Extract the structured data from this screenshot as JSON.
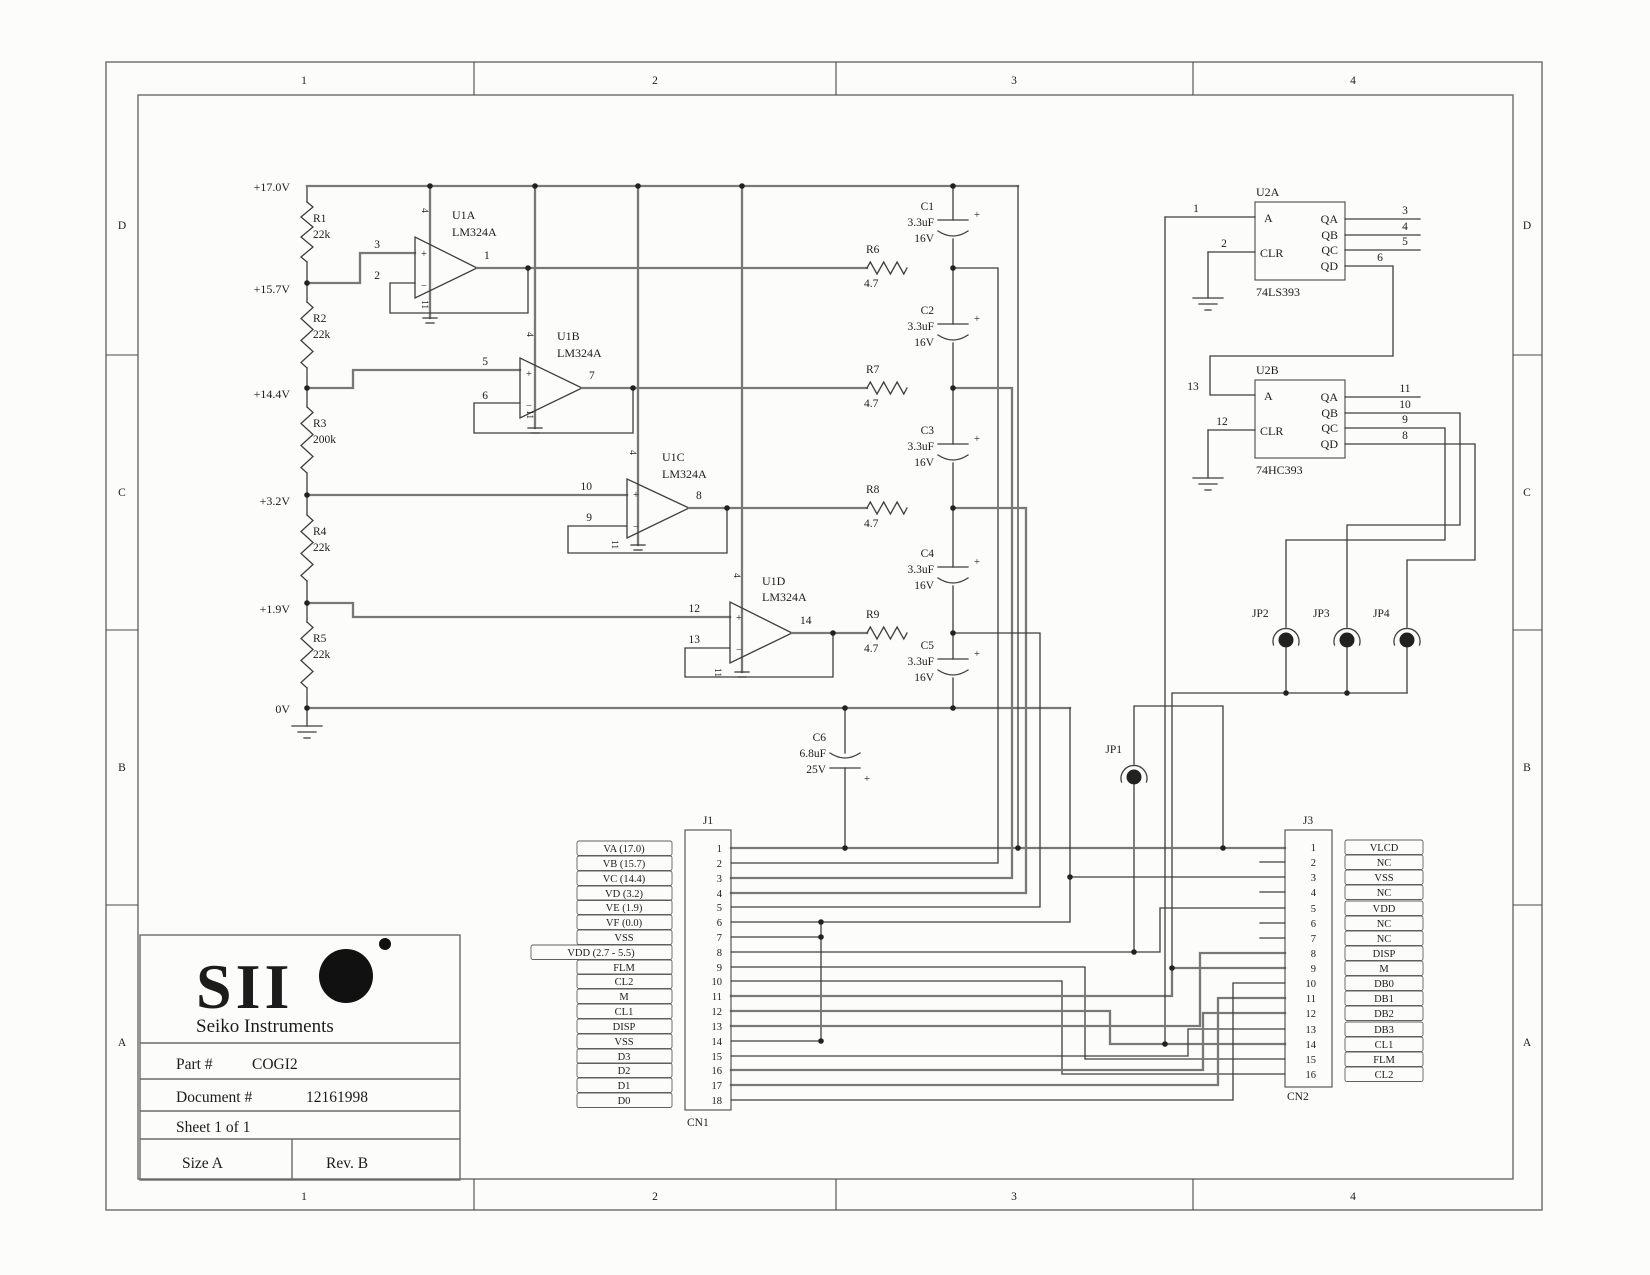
{
  "border": {
    "cols": [
      "1",
      "2",
      "3",
      "4"
    ],
    "rows": [
      "D",
      "C",
      "B",
      "A"
    ]
  },
  "ladder": {
    "rails": [
      "+17.0V",
      "+15.7V",
      "+14.4V",
      "+3.2V",
      "+1.9V",
      "0V"
    ],
    "resistors": [
      {
        "ref": "R1",
        "value": "22k"
      },
      {
        "ref": "R2",
        "value": "22k"
      },
      {
        "ref": "R3",
        "value": "200k"
      },
      {
        "ref": "R4",
        "value": "22k"
      },
      {
        "ref": "R5",
        "value": "22k"
      }
    ]
  },
  "opamps": [
    {
      "name": "U1A",
      "part": "LM324A",
      "pin_plus": "3",
      "pin_minus": "2",
      "pin_out": "1",
      "pin_vcc": "4",
      "pin_vee": "11"
    },
    {
      "name": "U1B",
      "part": "LM324A",
      "pin_plus": "5",
      "pin_minus": "6",
      "pin_out": "7",
      "pin_vcc": "4",
      "pin_vee": "11"
    },
    {
      "name": "U1C",
      "part": "LM324A",
      "pin_plus": "10",
      "pin_minus": "9",
      "pin_out": "8",
      "pin_vcc": "4",
      "pin_vee": "11"
    },
    {
      "name": "U1D",
      "part": "LM324A",
      "pin_plus": "12",
      "pin_minus": "13",
      "pin_out": "14",
      "pin_vcc": "4",
      "pin_vee": "11"
    }
  ],
  "series_resistors": [
    {
      "ref": "R6",
      "value": "4.7"
    },
    {
      "ref": "R7",
      "value": "4.7"
    },
    {
      "ref": "R8",
      "value": "4.7"
    },
    {
      "ref": "R9",
      "value": "4.7"
    }
  ],
  "caps": [
    {
      "ref": "C1",
      "value": "3.3uF",
      "volt": "16V"
    },
    {
      "ref": "C2",
      "value": "3.3uF",
      "volt": "16V"
    },
    {
      "ref": "C3",
      "value": "3.3uF",
      "volt": "16V"
    },
    {
      "ref": "C4",
      "value": "3.3uF",
      "volt": "16V"
    },
    {
      "ref": "C5",
      "value": "3.3uF",
      "volt": "16V"
    },
    {
      "ref": "C6",
      "value": "6.8uF",
      "volt": "25V"
    }
  ],
  "counters": [
    {
      "name": "U2A",
      "part": "74LS393",
      "in_a": {
        "pin": "1",
        "label": "A"
      },
      "in_clr": {
        "pin": "2",
        "label": "CLR"
      },
      "outputs": [
        {
          "label": "QA",
          "pin": "3"
        },
        {
          "label": "QB",
          "pin": "4"
        },
        {
          "label": "QC",
          "pin": "5"
        },
        {
          "label": "QD",
          "pin": "6"
        }
      ]
    },
    {
      "name": "U2B",
      "part": "74HC393",
      "in_a": {
        "pin": "13",
        "label": "A"
      },
      "in_clr": {
        "pin": "12",
        "label": "CLR"
      },
      "outputs": [
        {
          "label": "QA",
          "pin": "11"
        },
        {
          "label": "QB",
          "pin": "10"
        },
        {
          "label": "QC",
          "pin": "9"
        },
        {
          "label": "QD",
          "pin": "8"
        }
      ]
    }
  ],
  "jumpers": [
    "JP1",
    "JP2",
    "JP3",
    "JP4"
  ],
  "cn1": {
    "designator": "J1",
    "name": "CN1",
    "pins": [
      {
        "num": "1",
        "label": "VA (17.0)"
      },
      {
        "num": "2",
        "label": "VB (15.7)"
      },
      {
        "num": "3",
        "label": "VC (14.4)"
      },
      {
        "num": "4",
        "label": "VD (3.2)"
      },
      {
        "num": "5",
        "label": "VE (1.9)"
      },
      {
        "num": "6",
        "label": "VF (0.0)"
      },
      {
        "num": "7",
        "label": "VSS"
      },
      {
        "num": "8",
        "label": "VDD (2.7 - 5.5)"
      },
      {
        "num": "9",
        "label": "FLM"
      },
      {
        "num": "10",
        "label": "CL2"
      },
      {
        "num": "11",
        "label": "M"
      },
      {
        "num": "12",
        "label": "CL1"
      },
      {
        "num": "13",
        "label": "DISP"
      },
      {
        "num": "14",
        "label": "VSS"
      },
      {
        "num": "15",
        "label": "D3"
      },
      {
        "num": "16",
        "label": "D2"
      },
      {
        "num": "17",
        "label": "D1"
      },
      {
        "num": "18",
        "label": "D0"
      }
    ]
  },
  "cn2": {
    "designator": "J3",
    "name": "CN2",
    "pins": [
      {
        "num": "1",
        "label": "VLCD"
      },
      {
        "num": "2",
        "label": "NC"
      },
      {
        "num": "3",
        "label": "VSS"
      },
      {
        "num": "4",
        "label": "NC"
      },
      {
        "num": "5",
        "label": "VDD"
      },
      {
        "num": "6",
        "label": "NC"
      },
      {
        "num": "7",
        "label": "NC"
      },
      {
        "num": "8",
        "label": "DISP"
      },
      {
        "num": "9",
        "label": "M"
      },
      {
        "num": "10",
        "label": "DB0"
      },
      {
        "num": "11",
        "label": "DB1"
      },
      {
        "num": "12",
        "label": "DB2"
      },
      {
        "num": "13",
        "label": "DB3"
      },
      {
        "num": "14",
        "label": "CL1"
      },
      {
        "num": "15",
        "label": "FLM"
      },
      {
        "num": "16",
        "label": "CL2"
      }
    ]
  },
  "title_block": {
    "brand": "SII",
    "company": "Seiko Instruments",
    "part_label": "Part #",
    "part_number": "COGI2",
    "document_label": "Document #",
    "document_number": "12161998",
    "sheet": "Sheet  1  of  1",
    "size": "Size  A",
    "rev": "Rev.  B"
  }
}
